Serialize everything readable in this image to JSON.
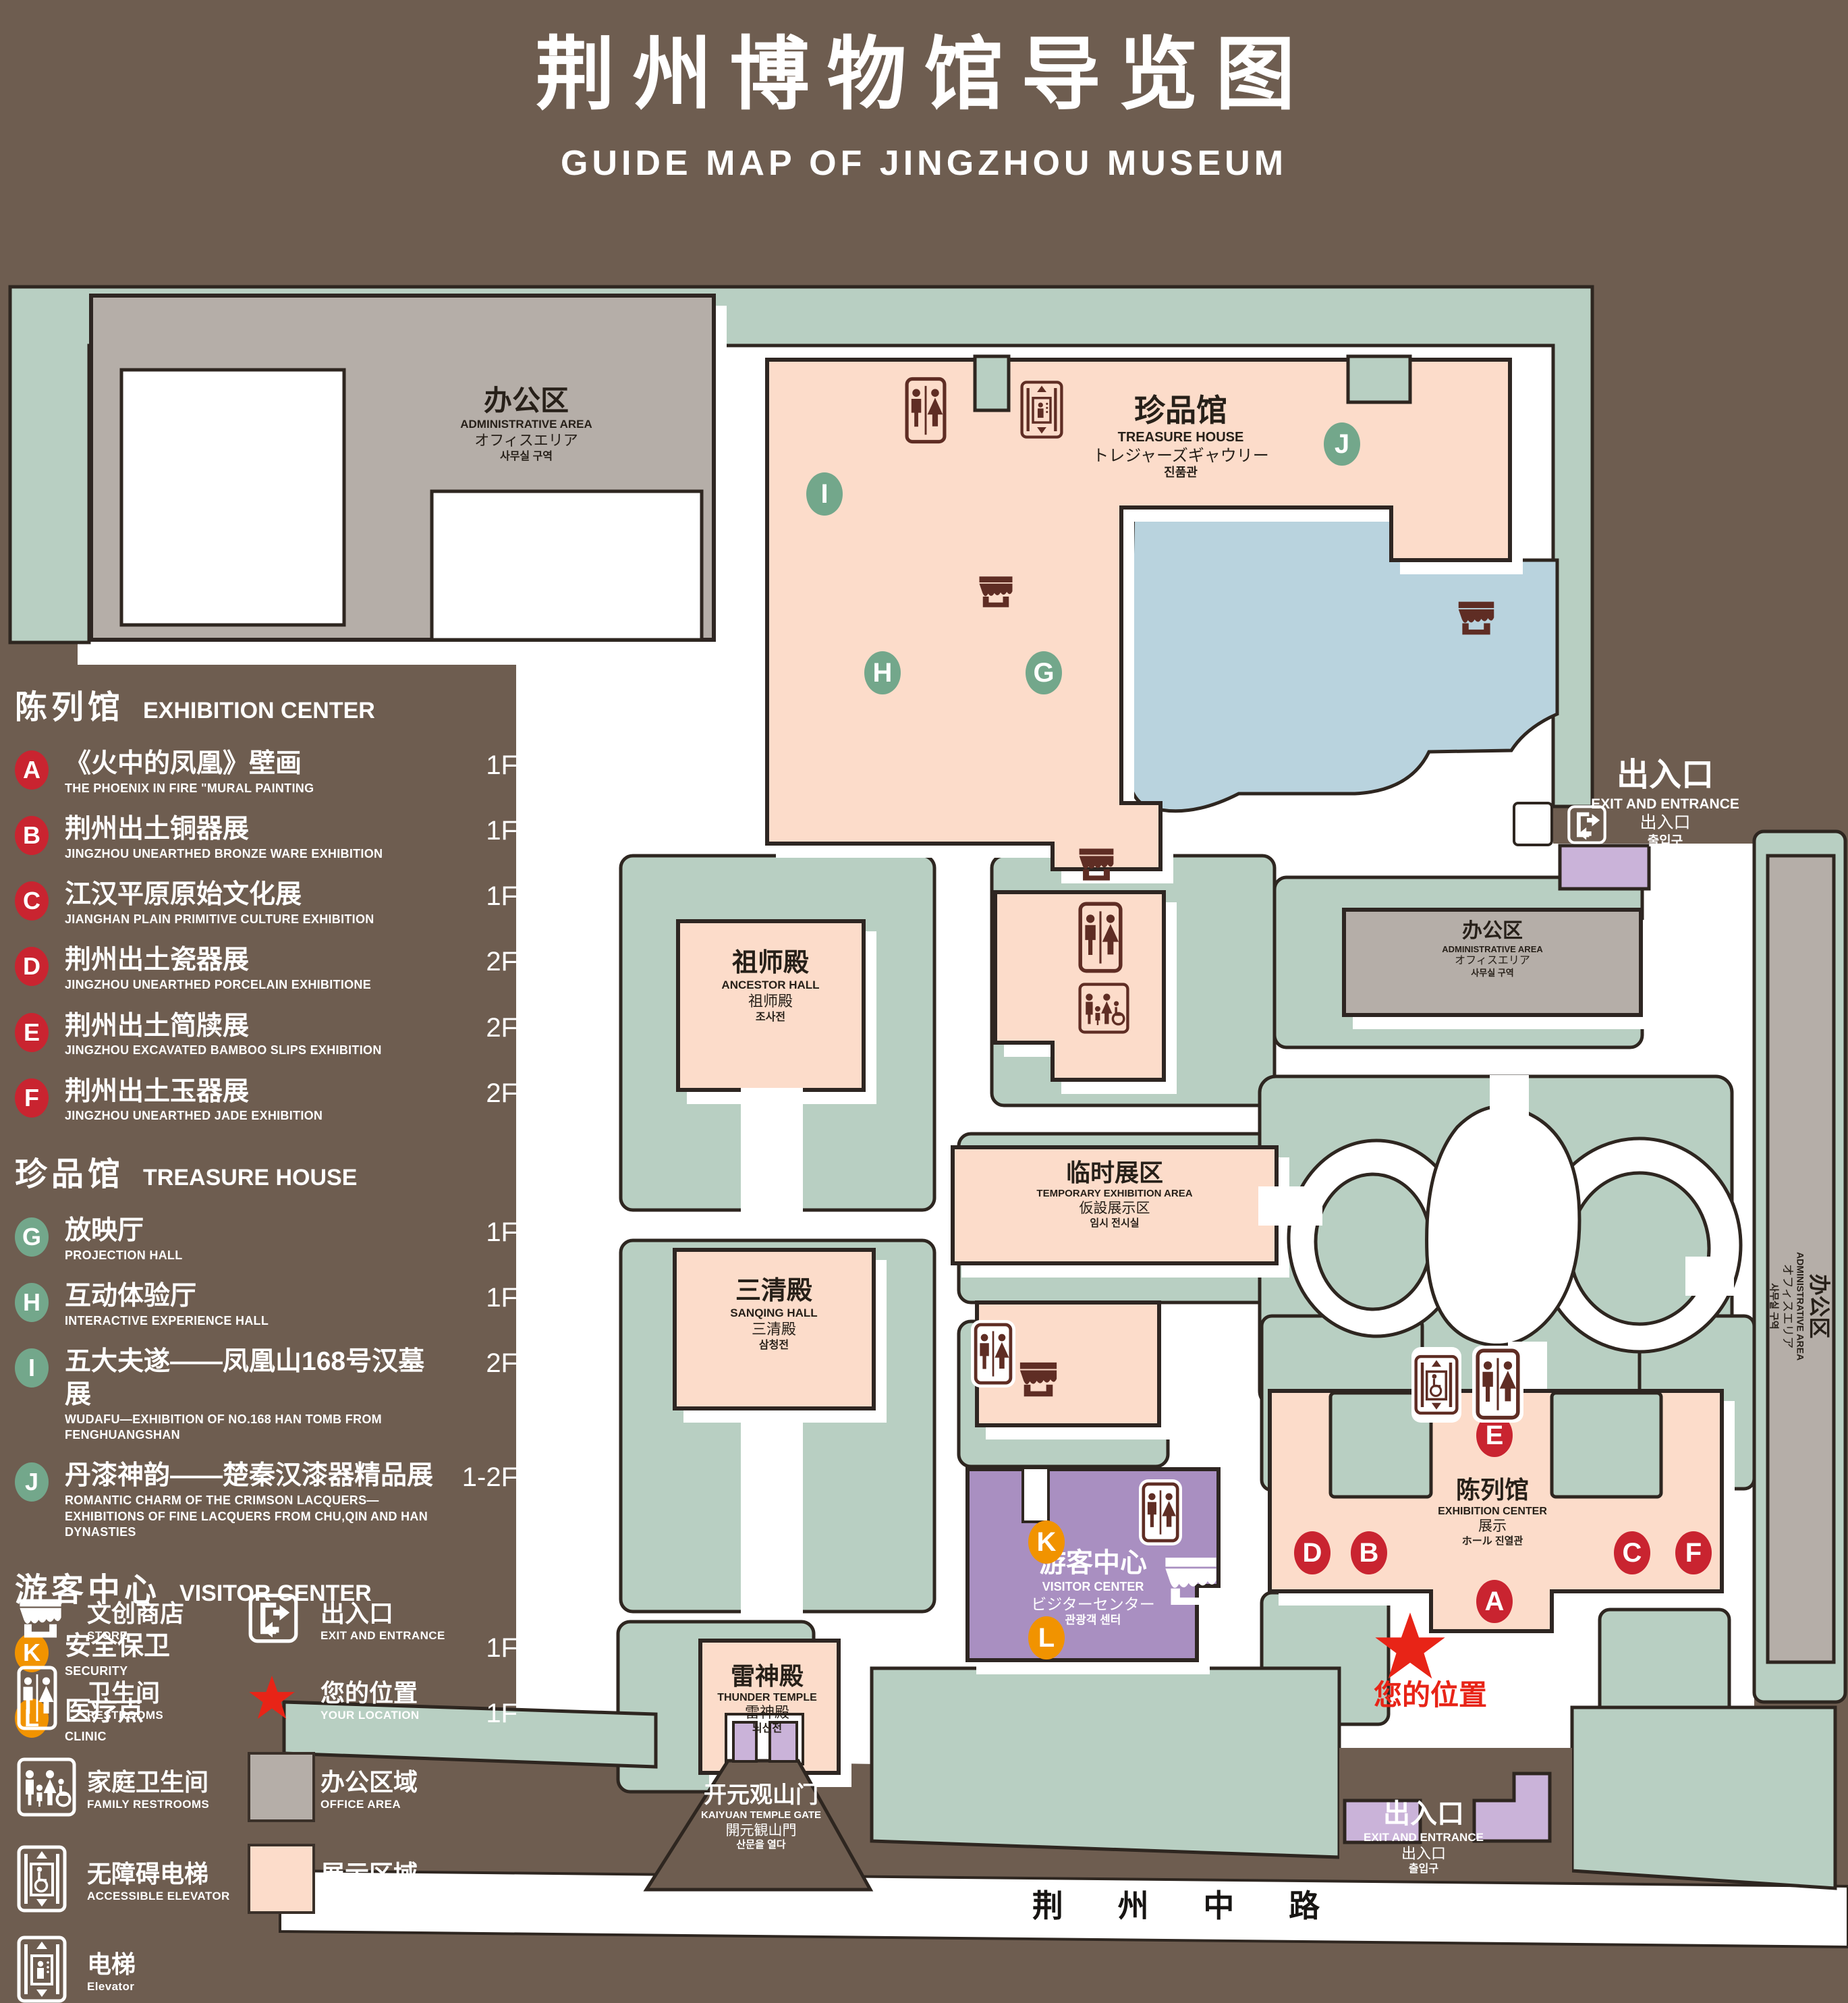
{
  "title": {
    "zh": "荆州博物馆导览图",
    "en": "GUIDE MAP OF JINGZHOU MUSEUM"
  },
  "colors": {
    "background": "#6e5d50",
    "lawn": "#b8cfc2",
    "display_area": "#fcdcca",
    "office_area": "#b5aea8",
    "pond": "#b9d3de",
    "visitor_center": "#a98fc1",
    "entrance_block": "#cab3d9",
    "outline": "#2e2620",
    "icon_dark": "#5f2d24",
    "marker_red": "#c92430",
    "marker_green": "#73a78b",
    "marker_orange": "#f19300",
    "location_red": "#e82417"
  },
  "legend": {
    "sections": [
      {
        "zh": "陈列馆",
        "en": "EXHIBITION CENTER",
        "items": [
          {
            "key": "A",
            "zh": "《火中的凤凰》壁画",
            "en": "THE PHOENIX IN FIRE \"MURAL PAINTING",
            "floor": "1F"
          },
          {
            "key": "B",
            "zh": "荆州出土铜器展",
            "en": "JINGZHOU UNEARTHED BRONZE WARE EXHIBITION",
            "floor": "1F"
          },
          {
            "key": "C",
            "zh": "江汉平原原始文化展",
            "en": "JIANGHAN PLAIN PRIMITIVE CULTURE EXHIBITION",
            "floor": "1F"
          },
          {
            "key": "D",
            "zh": "荆州出土瓷器展",
            "en": "JINGZHOU UNEARTHED PORCELAIN EXHIBITIONE",
            "floor": "2F"
          },
          {
            "key": "E",
            "zh": "荆州出土简牍展",
            "en": "JINGZHOU EXCAVATED BAMBOO SLIPS EXHIBITION",
            "floor": "2F"
          },
          {
            "key": "F",
            "zh": "荆州出土玉器展",
            "en": "JINGZHOU UNEARTHED JADE EXHIBITION",
            "floor": "2F"
          }
        ]
      },
      {
        "zh": "珍品馆",
        "en": "TREASURE HOUSE",
        "items": [
          {
            "key": "G",
            "zh": "放映厅",
            "en": "PROJECTION HALL",
            "floor": "1F"
          },
          {
            "key": "H",
            "zh": "互动体验厅",
            "en": "INTERACTIVE EXPERIENCE HALL",
            "floor": "1F"
          },
          {
            "key": "I",
            "zh": "五大夫遂——凤凰山168号汉墓展",
            "en": "WUDAFU—EXHIBITION OF NO.168 HAN TOMB FROM FENGHUANGSHAN",
            "floor": "2F"
          },
          {
            "key": "J",
            "zh": "丹漆神韵——楚秦汉漆器精品展",
            "en": "ROMANTIC CHARM OF THE CRIMSON LACQUERS—EXHIBITIONS OF FINE LACQUERS FROM CHU,QIN AND HAN DYNASTIES",
            "floor": "1-2F"
          }
        ]
      },
      {
        "zh": "游客中心",
        "en": "VISITOR CENTER",
        "items": [
          {
            "key": "K",
            "zh": "安全保卫",
            "en": "SECURITY",
            "floor": "1F"
          },
          {
            "key": "L",
            "zh": "医疗点",
            "en": "CLINIC",
            "floor": "1F"
          }
        ]
      }
    ],
    "symbols": [
      {
        "zh": "文创商店",
        "en": "STORE"
      },
      {
        "zh": "出入口",
        "en": "EXIT AND ENTRANCE"
      },
      {
        "zh": "卫生间",
        "en": "RESTROOMS"
      },
      {
        "zh": "您的位置",
        "en": "YOUR LOCATION"
      },
      {
        "zh": "家庭卫生间",
        "en": "FAMILY RESTROOMS"
      },
      {
        "zh": "办公区域",
        "en": "OFFICE AREA"
      },
      {
        "zh": "无障碍电梯",
        "en": "ACCESSIBLE ELEVATOR"
      },
      {
        "zh": "展示区域",
        "en": "DISPLAY AREA"
      },
      {
        "zh": "电梯",
        "en": "Elevator"
      }
    ]
  },
  "map": {
    "admin": {
      "zh": "办公区",
      "en": "ADMINISTRATIVE AREA",
      "ja": "オフィスエリア",
      "ko": "사무실 구역"
    },
    "treasure": {
      "zh": "珍品馆",
      "en": "TREASURE HOUSE",
      "ja": "トレジャーズギャウリー",
      "ko": "진품관"
    },
    "ancestor": {
      "zh": "祖师殿",
      "en": "ANCESTOR HALL",
      "zh2": "祖师殿",
      "ko": "조사전"
    },
    "temporary": {
      "zh": "临时展区",
      "en": "TEMPORARY EXHIBITION AREA",
      "ja": "仮設展示区",
      "ko": "임시 전시실"
    },
    "sanqing": {
      "zh": "三清殿",
      "en": "SANQING HALL",
      "zh2": "三清殿",
      "ko": "삼청전"
    },
    "thunder": {
      "zh": "雷神殿",
      "en": "THUNDER TEMPLE",
      "zh2": "雷神殿",
      "ko": "뇌신전"
    },
    "visitor": {
      "zh": "游客中心",
      "en": "VISITOR CENTER",
      "ja": "ビジターセンター",
      "ko": "관광객 센터"
    },
    "exhibition": {
      "zh": "陈列馆",
      "en": "EXHIBITION CENTER",
      "l3": "展示",
      "l4": "ホール 진열관"
    },
    "gate": {
      "zh": "开元观山门",
      "en": "KAIYUAN TEMPLE GATE",
      "ja": "開元観山門",
      "ko": "산문을 열다"
    },
    "exit": {
      "zh": "出入口",
      "en": "EXIT AND ENTRANCE",
      "zh2": "出入口",
      "ko": "출입구"
    },
    "your_location": "您的位置",
    "road": "荆 州 中 路",
    "markers": [
      {
        "letter": "A",
        "color": "red"
      },
      {
        "letter": "B",
        "color": "red"
      },
      {
        "letter": "C",
        "color": "red"
      },
      {
        "letter": "D",
        "color": "red"
      },
      {
        "letter": "E",
        "color": "red"
      },
      {
        "letter": "F",
        "color": "red"
      },
      {
        "letter": "G",
        "color": "green"
      },
      {
        "letter": "H",
        "color": "green"
      },
      {
        "letter": "I",
        "color": "green"
      },
      {
        "letter": "J",
        "color": "green"
      },
      {
        "letter": "K",
        "color": "orange"
      },
      {
        "letter": "L",
        "color": "orange"
      }
    ]
  }
}
